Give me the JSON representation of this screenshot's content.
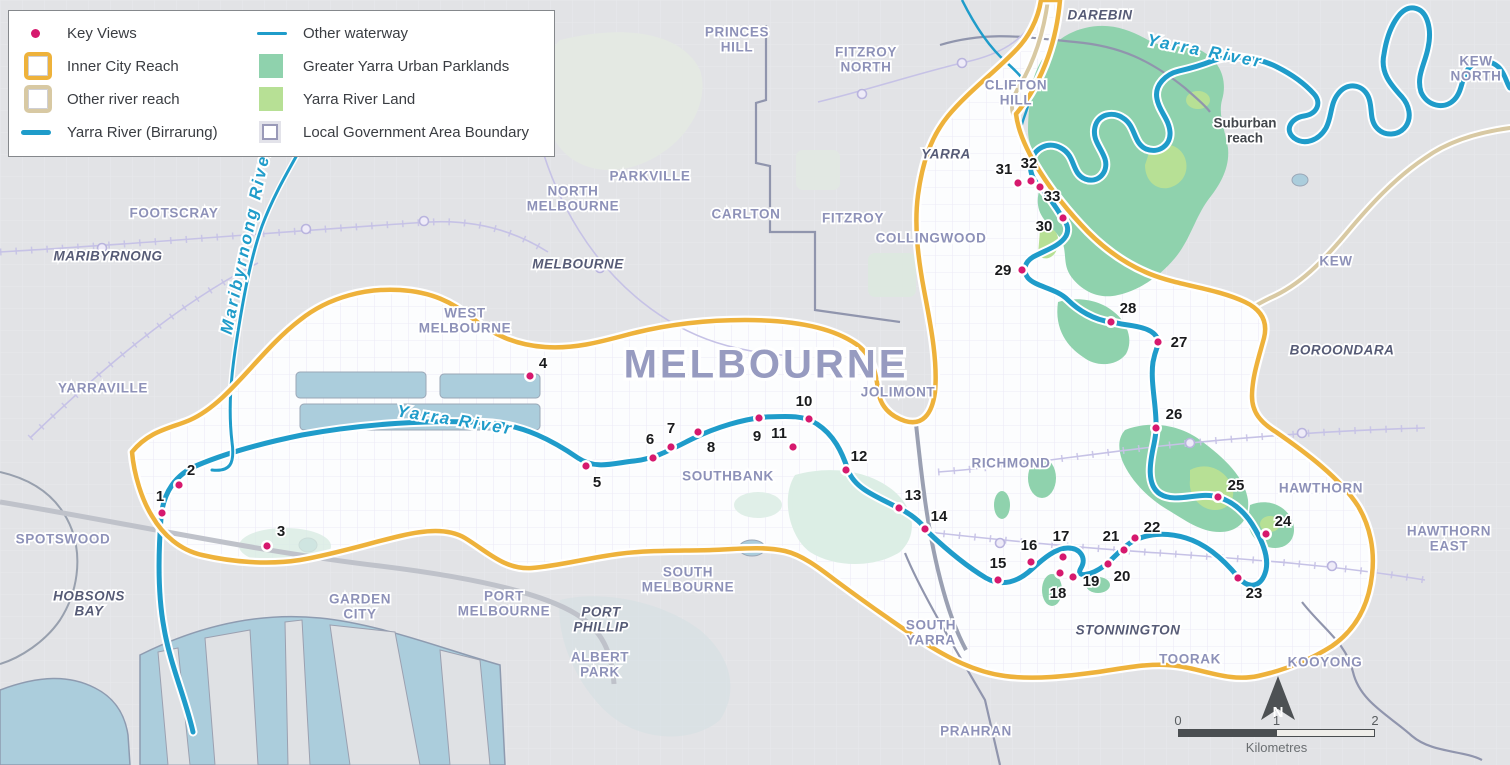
{
  "title": "Yarra River Inner City Reach key views map",
  "colors": {
    "key_view_dot": "#d6196e",
    "inner_city_reach": "#eeb23b",
    "other_river_reach": "#d8c9a3",
    "yarra_river": "#1f9cca",
    "parklands_teal": "#8fd2ad",
    "yarra_river_land_green": "#b7e095",
    "lga_boundary": "#9a9ab8",
    "land_outside": "#e2e3e6",
    "land_inside_reach": "#fcfdfe",
    "water": "#abcddc"
  },
  "legend": {
    "items": [
      {
        "label": "Key Views",
        "symbol": "key-views-dot"
      },
      {
        "label": "Inner City Reach",
        "symbol": "inner-city-reach-box"
      },
      {
        "label": "Other river reach",
        "symbol": "other-river-reach-box"
      },
      {
        "label": "Yarra River (Birrarung)",
        "symbol": "yarra-river-line"
      },
      {
        "label": "Other waterway",
        "symbol": "other-waterway-line"
      },
      {
        "label": "Greater Yarra Urban Parklands",
        "symbol": "parklands-fill"
      },
      {
        "label": "Yarra River Land",
        "symbol": "yarra-river-land-fill"
      },
      {
        "label": "Local Government Area Boundary",
        "symbol": "lga-boundary-box"
      }
    ]
  },
  "scale_bar": {
    "ticks": [
      "0",
      "1",
      "2"
    ],
    "unit": "Kilometres"
  },
  "north_arrow": {
    "label": "N"
  },
  "map": {
    "labels": [
      {
        "lines": [
          "PRINCES",
          "HILL"
        ],
        "x": 737,
        "y": 33,
        "type": "suburb"
      },
      {
        "lines": [
          "FITZROY",
          "NORTH"
        ],
        "x": 866,
        "y": 53,
        "type": "suburb"
      },
      {
        "lines": [
          "DAREBIN"
        ],
        "x": 1100,
        "y": 16,
        "type": "lga"
      },
      {
        "lines": [
          "CLIFTON",
          "HILL"
        ],
        "x": 1016,
        "y": 86,
        "type": "suburb"
      },
      {
        "lines": [
          "KEW",
          "NORTH"
        ],
        "x": 1476,
        "y": 62,
        "type": "suburb"
      },
      {
        "lines": [
          "KENSINGTON"
        ],
        "x": 412,
        "y": 150,
        "type": "suburb"
      },
      {
        "lines": [
          "PARKVILLE"
        ],
        "x": 650,
        "y": 177,
        "type": "suburb"
      },
      {
        "lines": [
          "NORTH",
          "MELBOURNE"
        ],
        "x": 573,
        "y": 192,
        "type": "suburb"
      },
      {
        "lines": [
          "CARLTON"
        ],
        "x": 746,
        "y": 215,
        "type": "suburb"
      },
      {
        "lines": [
          "FITZROY"
        ],
        "x": 853,
        "y": 219,
        "type": "suburb"
      },
      {
        "lines": [
          "YARRA"
        ],
        "x": 946,
        "y": 155,
        "type": "lga"
      },
      {
        "lines": [
          "COLLINGWOOD"
        ],
        "x": 931,
        "y": 239,
        "type": "suburb"
      },
      {
        "lines": [
          "MELBOURNE"
        ],
        "x": 578,
        "y": 265,
        "type": "lga"
      },
      {
        "lines": [
          "FOOTSCRAY"
        ],
        "x": 174,
        "y": 214,
        "type": "suburb"
      },
      {
        "lines": [
          "MARIBYRNONG"
        ],
        "x": 108,
        "y": 257,
        "type": "lga"
      },
      {
        "lines": [
          "WEST",
          "MELBOURNE"
        ],
        "x": 465,
        "y": 314,
        "type": "suburb"
      },
      {
        "lines": [
          "KEW"
        ],
        "x": 1336,
        "y": 262,
        "type": "suburb"
      },
      {
        "lines": [
          "BOROONDARA"
        ],
        "x": 1342,
        "y": 351,
        "type": "lga"
      },
      {
        "lines": [
          "YARRAVILLE"
        ],
        "x": 103,
        "y": 389,
        "type": "suburb"
      },
      {
        "lines": [
          "MELBOURNE"
        ],
        "x": 766,
        "y": 367,
        "type": "city"
      },
      {
        "lines": [
          "JOLIMONT"
        ],
        "x": 898,
        "y": 393,
        "type": "suburb"
      },
      {
        "lines": [
          "RICHMOND"
        ],
        "x": 1011,
        "y": 464,
        "type": "suburb"
      },
      {
        "lines": [
          "SOUTHBANK"
        ],
        "x": 728,
        "y": 477,
        "type": "suburb"
      },
      {
        "lines": [
          "SPOTSWOOD"
        ],
        "x": 63,
        "y": 540,
        "type": "suburb"
      },
      {
        "lines": [
          "HAWTHORN"
        ],
        "x": 1321,
        "y": 489,
        "type": "suburb"
      },
      {
        "lines": [
          "HAWTHORN",
          "EAST"
        ],
        "x": 1449,
        "y": 532,
        "type": "suburb"
      },
      {
        "lines": [
          "HOBSONS",
          "BAY"
        ],
        "x": 89,
        "y": 597,
        "type": "lga"
      },
      {
        "lines": [
          "SOUTH",
          "MELBOURNE"
        ],
        "x": 688,
        "y": 573,
        "type": "suburb"
      },
      {
        "lines": [
          "GARDEN",
          "CITY"
        ],
        "x": 360,
        "y": 600,
        "type": "suburb"
      },
      {
        "lines": [
          "PORT",
          "MELBOURNE"
        ],
        "x": 504,
        "y": 597,
        "type": "suburb"
      },
      {
        "lines": [
          "PORT",
          "PHILLIP"
        ],
        "x": 601,
        "y": 613,
        "type": "lga"
      },
      {
        "lines": [
          "ALBERT",
          "PARK"
        ],
        "x": 600,
        "y": 658,
        "type": "suburb"
      },
      {
        "lines": [
          "SOUTH",
          "YARRA"
        ],
        "x": 931,
        "y": 626,
        "type": "suburb"
      },
      {
        "lines": [
          "STONNINGTON"
        ],
        "x": 1128,
        "y": 631,
        "type": "lga"
      },
      {
        "lines": [
          "TOORAK"
        ],
        "x": 1190,
        "y": 660,
        "type": "suburb"
      },
      {
        "lines": [
          "KOOYONG"
        ],
        "x": 1325,
        "y": 663,
        "type": "suburb"
      },
      {
        "lines": [
          "PRAHRAN"
        ],
        "x": 976,
        "y": 732,
        "type": "suburb"
      },
      {
        "lines": [
          "Suburban",
          "reach"
        ],
        "x": 1245,
        "y": 124,
        "type": "note"
      },
      {
        "lines": [
          "Yarra River"
        ],
        "x": 1205,
        "y": 52,
        "type": "river",
        "rotate": 11
      },
      {
        "lines": [
          "Yarra River"
        ],
        "x": 455,
        "y": 421,
        "type": "river",
        "rotate": 9
      },
      {
        "lines": [
          "Maribyrnong River"
        ],
        "x": 247,
        "y": 240,
        "type": "river",
        "rotate": -78,
        "size": 14
      }
    ],
    "key_views": [
      {
        "n": "1",
        "x": 162,
        "y": 513,
        "lx": 160,
        "ly": 497
      },
      {
        "n": "2",
        "x": 179,
        "y": 485,
        "lx": 191,
        "ly": 471
      },
      {
        "n": "3",
        "x": 267,
        "y": 546,
        "lx": 281,
        "ly": 532
      },
      {
        "n": "4",
        "x": 530,
        "y": 376,
        "lx": 543,
        "ly": 364
      },
      {
        "n": "5",
        "x": 586,
        "y": 466,
        "lx": 597,
        "ly": 483
      },
      {
        "n": "6",
        "x": 653,
        "y": 458,
        "lx": 650,
        "ly": 440
      },
      {
        "n": "7",
        "x": 671,
        "y": 447,
        "lx": 671,
        "ly": 429
      },
      {
        "n": "8",
        "x": 698,
        "y": 432,
        "lx": 711,
        "ly": 448
      },
      {
        "n": "9",
        "x": 759,
        "y": 418,
        "lx": 757,
        "ly": 437
      },
      {
        "n": "10",
        "x": 809,
        "y": 419,
        "lx": 804,
        "ly": 402
      },
      {
        "n": "11",
        "x": 793,
        "y": 447,
        "lx": 779,
        "ly": 434
      },
      {
        "n": "12",
        "x": 846,
        "y": 470,
        "lx": 859,
        "ly": 457
      },
      {
        "n": "13",
        "x": 899,
        "y": 508,
        "lx": 913,
        "ly": 496
      },
      {
        "n": "14",
        "x": 925,
        "y": 529,
        "lx": 939,
        "ly": 517
      },
      {
        "n": "15",
        "x": 998,
        "y": 580,
        "lx": 998,
        "ly": 564
      },
      {
        "n": "16",
        "x": 1031,
        "y": 562,
        "lx": 1029,
        "ly": 546
      },
      {
        "n": "17",
        "x": 1063,
        "y": 557,
        "lx": 1061,
        "ly": 537
      },
      {
        "n": "18",
        "x": 1060,
        "y": 573,
        "lx": 1058,
        "ly": 594
      },
      {
        "n": "19",
        "x": 1073,
        "y": 577,
        "lx": 1091,
        "ly": 582
      },
      {
        "n": "20",
        "x": 1108,
        "y": 564,
        "lx": 1122,
        "ly": 577
      },
      {
        "n": "21",
        "x": 1124,
        "y": 550,
        "lx": 1111,
        "ly": 537
      },
      {
        "n": "22",
        "x": 1135,
        "y": 538,
        "lx": 1152,
        "ly": 528
      },
      {
        "n": "23",
        "x": 1238,
        "y": 578,
        "lx": 1254,
        "ly": 594
      },
      {
        "n": "24",
        "x": 1266,
        "y": 534,
        "lx": 1283,
        "ly": 522
      },
      {
        "n": "25",
        "x": 1218,
        "y": 497,
        "lx": 1236,
        "ly": 486
      },
      {
        "n": "26",
        "x": 1156,
        "y": 428,
        "lx": 1174,
        "ly": 415
      },
      {
        "n": "27",
        "x": 1158,
        "y": 342,
        "lx": 1179,
        "ly": 343
      },
      {
        "n": "28",
        "x": 1111,
        "y": 322,
        "lx": 1128,
        "ly": 309
      },
      {
        "n": "29",
        "x": 1022,
        "y": 270,
        "lx": 1003,
        "ly": 271
      },
      {
        "n": "30",
        "x": 1063,
        "y": 218,
        "lx": 1044,
        "ly": 227
      },
      {
        "n": "31",
        "x": 1018,
        "y": 183,
        "lx": 1004,
        "ly": 170
      },
      {
        "n": "32",
        "x": 1031,
        "y": 181,
        "lx": 1029,
        "ly": 164
      },
      {
        "n": "33",
        "x": 1040,
        "y": 187,
        "lx": 1052,
        "ly": 197
      }
    ]
  }
}
